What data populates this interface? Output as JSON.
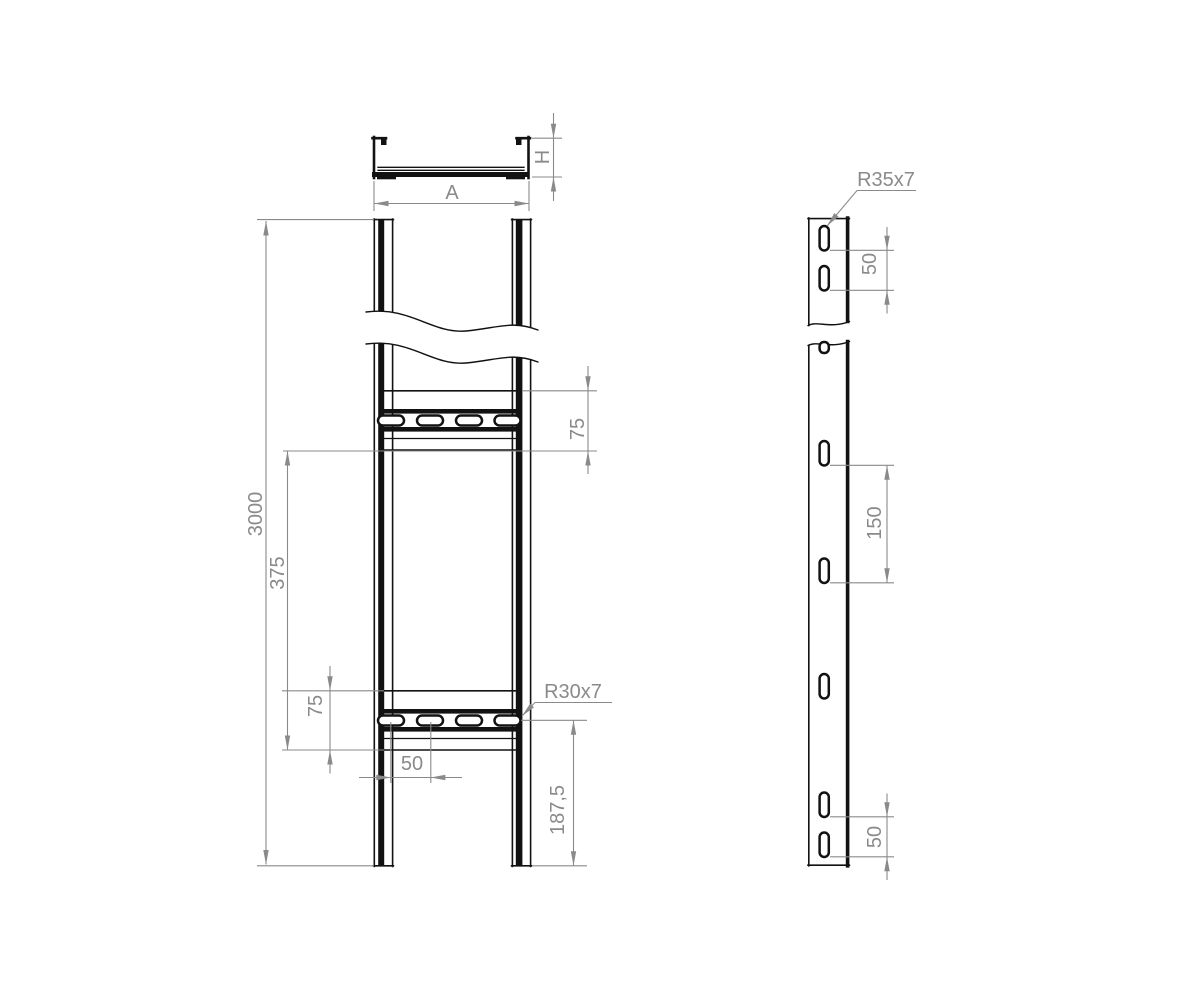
{
  "labels": {
    "section": {
      "width": "A",
      "height": "H"
    },
    "front": {
      "length": "3000",
      "pitch": "375",
      "rung_h_top": "75",
      "rung_h_bot": "75",
      "hole_pitch": "50",
      "slot": "R30x7",
      "end_offset": "187,5"
    },
    "side": {
      "slot": "R35x7",
      "p_top": "50",
      "p_mid": "150",
      "p_bot": "50"
    }
  },
  "colors": {
    "part_line": "#121212",
    "dimension": "#8a8a8a",
    "background": "#ffffff"
  }
}
